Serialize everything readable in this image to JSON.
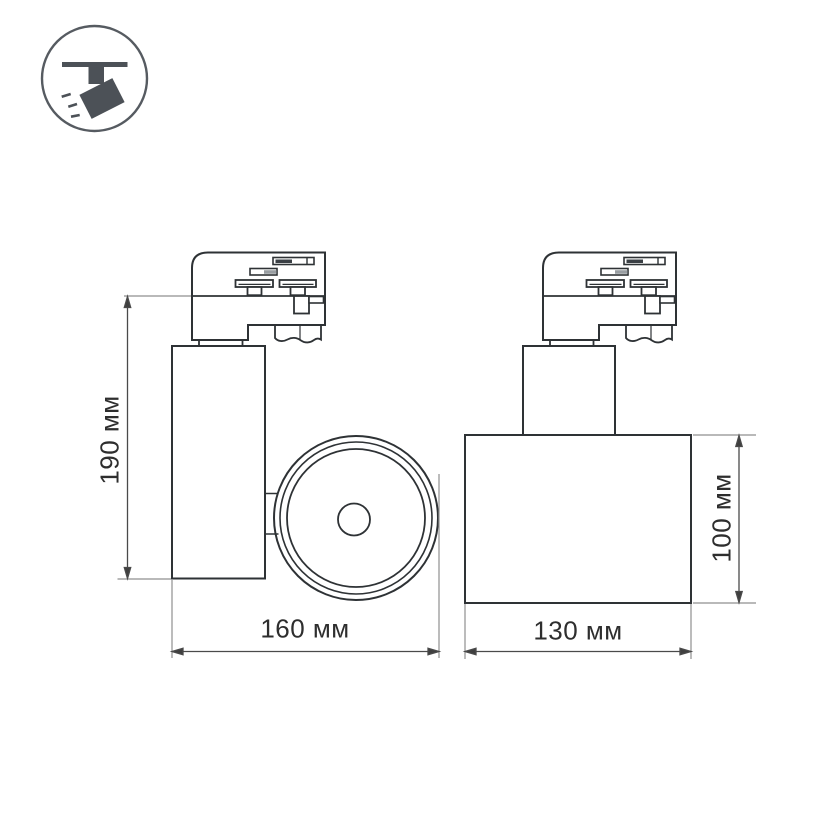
{
  "icon": {
    "name": "track-spotlight-icon"
  },
  "dimensions": {
    "height_left": "190 мм",
    "width_left": "160 мм",
    "width_right": "130 мм",
    "height_right": "100 мм"
  },
  "colors": {
    "background": "#ffffff",
    "outline": "#2e3235",
    "dim_line": "#4a4a4a",
    "extension_line": "#8f8f8f",
    "text": "#2e2e2e",
    "icon": "#4c5157",
    "contact_dark": "#3a3f44",
    "contact_gray": "#999ea2"
  }
}
